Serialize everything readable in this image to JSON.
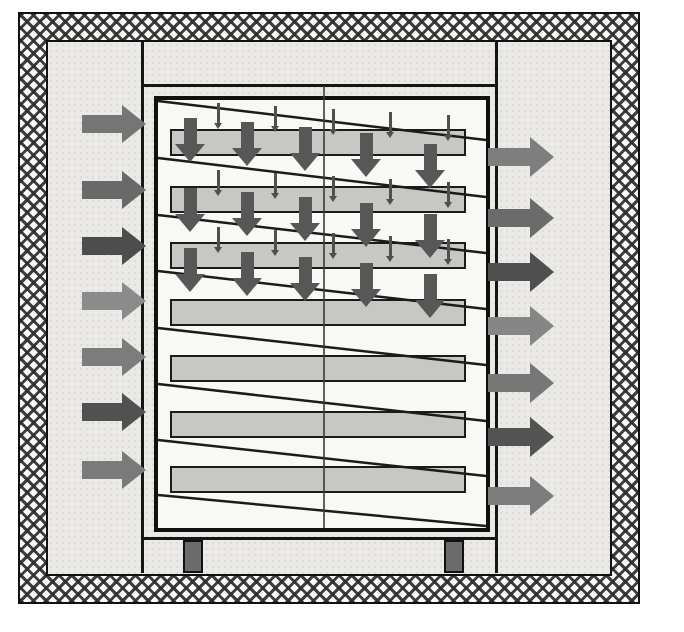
{
  "meta": {
    "description": "Cross-section schematic of an insulated cabinet tray dryer with serpentine airflow: hot air enters at left, flows over stacked trays, exits at right",
    "text_content": "none"
  },
  "palette": {
    "background": "#ffffff",
    "interior_fill": "#eae9e6",
    "cabinet_fill": "#f8f8f5",
    "tray_fill": "#c7c7c4",
    "line": "#1b1b1b",
    "down_arrow": "#575757",
    "tick_arrow": "#4f4f4f",
    "leg_fill": "#6b6b6b"
  },
  "insulated_shell": {
    "x": 18,
    "y": 12,
    "w": 622,
    "h": 592,
    "band": 30
  },
  "chamber": {
    "left_wall_x": 141,
    "right_wall_x": 495,
    "wall_w": 3,
    "wall_top": 42,
    "wall_h": 531,
    "top_plate_y": 84,
    "bottom_plate_y": 537,
    "plate_x": 141,
    "plate_w": 357,
    "plate_h": 3,
    "seam_x": 324,
    "seam_y1": 86,
    "seam_y2": 528
  },
  "cabinet": {
    "x": 154,
    "y": 96,
    "w": 336,
    "h": 436
  },
  "trays": {
    "x": 170,
    "w": 296,
    "h": 27,
    "tops": [
      129,
      186,
      242,
      299,
      355,
      411,
      466
    ]
  },
  "baffle_lines": [
    [
      158,
      101,
      486,
      140
    ],
    [
      158,
      158,
      486,
      197
    ],
    [
      158,
      215,
      486,
      253
    ],
    [
      158,
      271,
      486,
      309
    ],
    [
      158,
      328,
      486,
      365
    ],
    [
      158,
      384,
      486,
      421
    ],
    [
      158,
      440,
      486,
      476
    ],
    [
      158,
      495,
      486,
      526
    ]
  ],
  "down_arrow_rows": {
    "tops": [
      118,
      188,
      248
    ],
    "x_centers": [
      190,
      247,
      305,
      366,
      430
    ],
    "y_offsets": [
      0,
      4,
      9,
      15,
      26
    ],
    "w": 30,
    "h": 44,
    "body_w": 13,
    "body_h": 26,
    "head_h": 18
  },
  "tick_arrow_rows": {
    "tops": [
      103,
      170,
      227
    ],
    "x_centers": [
      218,
      275,
      333,
      390,
      448
    ],
    "y_offsets": [
      0,
      3,
      6,
      9,
      12
    ],
    "w": 9,
    "h": 26,
    "stem_w": 3,
    "stem_h": 20,
    "head_h": 6
  },
  "inlet_arrows": {
    "x": 82,
    "w": 64,
    "h": 38,
    "body_w": 40,
    "body_h": 18,
    "y_centers": [
      124,
      190,
      246,
      301,
      357,
      412,
      470
    ],
    "colors": [
      "#757575",
      "#696969",
      "#4d4d4d",
      "#8b8b8b",
      "#7c7c7c",
      "#515151",
      "#7a7a7a"
    ]
  },
  "outlet_arrows": {
    "x": 488,
    "w": 66,
    "h": 40,
    "body_w": 42,
    "body_h": 18,
    "y_centers": [
      157,
      218,
      272,
      326,
      383,
      437,
      496
    ],
    "colors": [
      "#7e7e7e",
      "#6b6b6b",
      "#4f4f4f",
      "#868686",
      "#777777",
      "#535353",
      "#7c7c7c"
    ]
  },
  "legs": {
    "xs": [
      183,
      444
    ],
    "y": 540,
    "w": 20,
    "h": 33
  }
}
